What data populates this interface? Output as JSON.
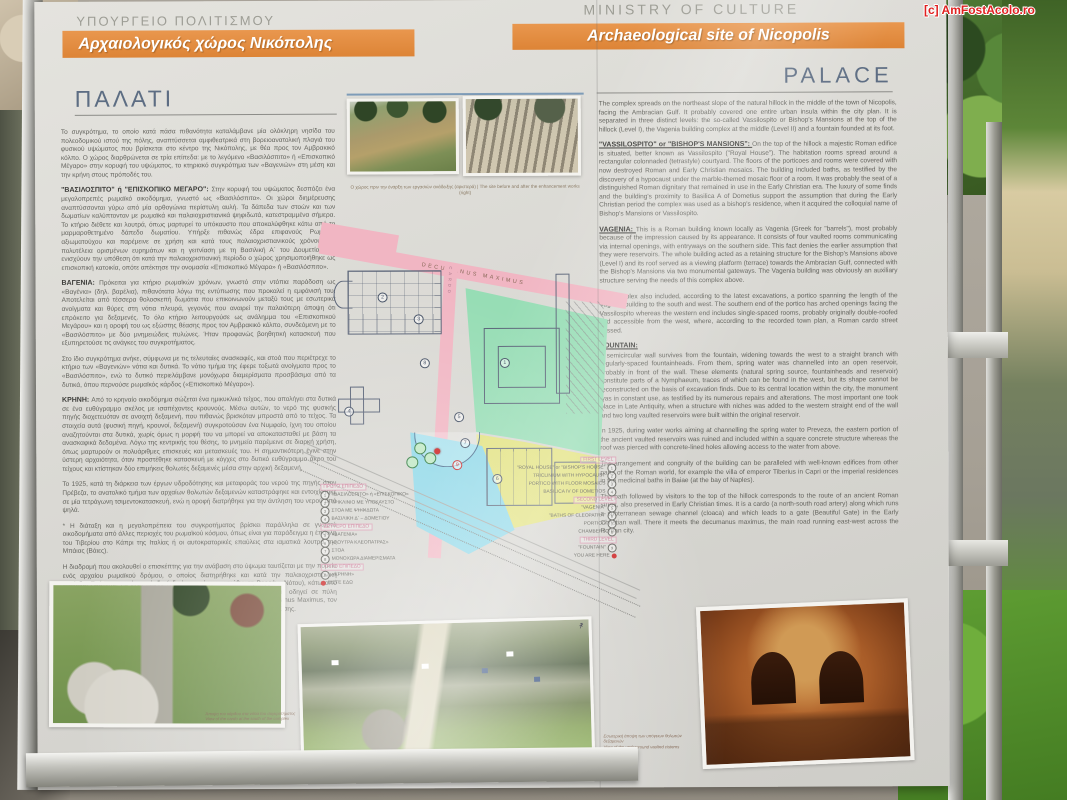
{
  "watermark": "[c] AmFostAcolo.ro",
  "header": {
    "gr": {
      "ministry": "ΥΠΟΥΡΓΕΙΟ ΠΟΛΙΤΙΣΜΟΥ",
      "banner": "Αρχαιολογικός χώρος Νικόπολης",
      "title": "ΠΑΛΑΤΙ"
    },
    "en": {
      "ministry": "MINISTRY OF CULTURE",
      "banner": "Archaeological site of Nicopolis",
      "title": "PALACE"
    }
  },
  "colors": {
    "banner_orange": "#e08a3c",
    "title_blue": "#5d6d83",
    "map_green": "#97ddb5",
    "map_yellow": "#e2e27e",
    "map_cyan": "#8fd8e8",
    "map_pink": "#f1b6c3",
    "marker_red": "#cc2020"
  },
  "left": {
    "sections": [
      {
        "head": "",
        "text": "Το συγκρότημα, το οποίο κατά πάσα πιθανότητα καταλάμβανε μία ολόκληρη νησίδα του πολεοδομικού ιστού της πόλης, αναπτύσσεται αμφιθεατρικά στη βορειοανατολική πλαγιά του φυσικού υψώματος που βρίσκεται στο κέντρο της Νικόπολης, με θέα προς τον Αμβρακικό κόλπο. Ο χώρος διαρθρώνεται σε τρία επίπεδα: με το λεγόμενο «Βασιλόσπιτο» ή «Επισκοπικό Μέγαρο» στην κορυφή του υψώματος, το κτηριακό συγκρότημα των «Βαγενιών» στη μέση και την κρήνη στους πρόποδές του."
      },
      {
        "head": "\"ΒΑΣΙΛΟΣΠΙΤΟ\" ή \"ΕΠΙΣΚΟΠΙΚΟ ΜΕΓΑΡΟ\": ",
        "text": "Στην κορυφή του υψώματος δεσπόζει ένα μεγαλοπρεπές ρωμαϊκό οικοδόμημα, γνωστό ως «Βασιλόσπιτο». Οι χώροι διημέρευσης αναπτύσσονται γύρω από μία ορθογώνια περίστυλη αυλή. Τα δάπεδα των στοών και των δωματίων καλύπτονταν με ρωμαϊκά και παλαιοχριστιανικά ψηφιδωτά, κατεστραμμένα σήμερα. Το κτήριο διέθετε και λουτρά, όπως μαρτυρεί το υπόκαυστο που αποκαλύφθηκε κάτω από το μαρμαροθετημένο δάπεδο δωματίου. Υπήρξε πιθανώς έδρα επιφανούς Ρωμαίου αξιωματούχου και παρέμεινε σε χρήση και κατά τους παλαιοχριστιανικούς χρόνους. Η πολυτέλεια ορισμένων ευρημάτων και η γειτνίαση με τη Βασιλική Α΄ του Δουμετίου (Σ) ενισχύουν την υπόθεση ότι κατά την παλαιοχριστιανική περίοδο ο χώρος χρησιμοποιήθηκε ως επισκοπική κατοικία, οπότε απέκτησε την ονομασία «Επισκοπικό Μέγαρο» ή «Βασιλόσπιτο»."
      },
      {
        "head": "ΒΑΓΕΝΙΑ: ",
        "text": "Πρόκειται για κτήριο ρωμαϊκών χρόνων, γνωστό στην ντόπια παράδοση ως «Βαγένια» (δηλ. βαρέλια), πιθανότατα λόγω της εντύπωσης που προκαλεί η εμφάνισή του. Αποτελείται από τέσσερα θολοσκεπή δωμάτια που επικοινωνούν μεταξύ τους με εσωτερικά ανοίγματα και θύρες στη νότια πλευρά, γεγονός που αναιρεί την παλαιότερη άποψη ότι επρόκειτο για δεξαμενές. Το όλο κτήριο λειτουργούσε ως ανάλημμα του «Επισκοπικού Μεγάρου» και η οροφή του ως εξώστης θέασης προς τον Αμβρακικό κόλπο, συνδεόμενη με το «Βασιλόσπιτο» με δύο μνημειώδεις πυλώνες. Ήταν προφανώς βοηθητική κατασκευή που εξυπηρετούσε τις ανάγκες του συγκροτήματος."
      },
      {
        "head": "",
        "text": "Στο ίδιο συγκρότημα ανήκε, σύμφωνα με τις τελευταίες ανασκαφές, και στοά που περιέτρεχε το κτήριο των «Βαγενιών» νότια και δυτικά. Το νότιο τμήμα της έφερε τοξωτά ανοίγματα προς το «Βασιλόσπιτο», ενώ το δυτικό περιελάμβανε μονόχωρα διαμερίσματα προσβάσιμα από τα δυτικά, όπου περνούσε ρωμαϊκός κάρδος («Επισκοπικό Μέγαρο»)."
      },
      {
        "head": "ΚΡΗΝΗ: ",
        "text": "Από το κρηναίο οικοδόμημα σώζεται ένα ημικυκλικό τείχος, που απολήγει στα δυτικά σε ένα ευθύγραμμο σκέλος με ισαπέχοντες κρουνούς. Μέσω αυτών, το νερό της φυσικής πηγής διοχετευόταν σε ανοιχτή δεξαμενή, που πιθανώς βρισκόταν μπροστά από το τείχος. Τα στοιχεία αυτά (φυσική πηγή, κρουνοί, δεξαμενή) συγκροτούσαν ένα Νυμφαίο, ίχνη του οποίου αναζητούνται στα δυτικά, χωρίς όμως η μορφή του να μπορεί να αποκατασταθεί με βάση τα ανασκαφικά δεδομένα. Λόγω της κεντρικής του θέσης, το μνημείο παρέμεινε σε διαρκή χρήση, όπως μαρτυρούν οι πολυάριθμες επισκευές και μετασκευές του. Η σημαντικότερη έγινε στην ύστερη αρχαιότητα, όταν προστέθηκε κατασκευή με κόγχες στο δυτικό ευθύγραμμο άκρο του τείχους και κτίστηκαν δύο επιμήκεις θολωτές δεξαμενές μέσα στην αρχική δεξαμενή."
      },
      {
        "head": "",
        "text": "Το 1925, κατά τη διάρκεια των έργων υδροδότησης και μεταφοράς του νερού της πηγής στην Πρέβεζα, το ανατολικό τμήμα των αρχαίων θολωτών δεξαμενών καταστράφηκε και εντοιχίστηκε σε μία τετράγωνη τσιμεντοκατασκευή, ενώ η οροφή διατρήθηκε για την άντληση του νερού από ψηλά."
      },
      {
        "head": "",
        "text": "* Η διάταξη και η μεγαλοπρέπεια του συγκροτήματος βρίσκει παράλληλα σε γνωστά οικοδομήματα από άλλες περιοχές του ρωμαϊκού κόσμου, όπως είναι για παράδειγμα η έπαυλη του Τιβερίου στο Κάπρι της Ιταλίας ή οι αυτοκρατορικές επαύλεις στα ιαματικά λουτρά της Μπάιας (Βάιες)."
      },
      {
        "head": "",
        "text": "Η διαδρομή που ακολουθεί ο επισκέπτης για την ανάβαση στο ύψωμα ταυτίζεται με την πορεία ενός αρχαίου ρωμαϊκού δρόμου, ο οποίος διατηρήθηκε και κατά την παλαιοχριστιανική περίοδο. Πρόκειται για έναν κάρδο (οδική αρτηρία με κατεύθυνση Βορρά – Νότου), κάτω από τον οποίο τρέχει υπόγειος αποχετευτικός αγωγός (cloaca), και ο οποίος οδηγεί σε πύλη («Ωραία Πύλη») του παλαιοχριστιανικού τείχους. Εκεί συναντά τον Decumanus Maximus, τον κεντρικό δρόμο που διέσχιζε τη ρωμαϊκή πόλη με κατεύθυνση Ανατολής – Δύσης."
      }
    ]
  },
  "right": {
    "sections": [
      {
        "head": "",
        "text": "The complex spreads on the northeast slope of the natural hillock in the middle of the town of Nicopolis, facing the Ambracian Gulf. It probably covered one entire urban insula within the city plan. It is separated in three distinct levels: the so-called Vassilospito or Bishop's Mansions at the top of the hillock (Level I), the Vagenia building complex at the middle (Level II) and a fountain founded at its foot."
      },
      {
        "head": "\"VASSILOSPITO\" or \"BISHOP'S MANSIONS\": ",
        "text": "On the top of the hillock a majestic Roman edifice is situated, better known as Vassilospito (\"Royal House\"). The habitation rooms spread around a rectangular colonnaded (tetrastyle) courtyard. The floors of the porticoes and rooms were covered with now destroyed Roman and Early Christian mosaics. The building included baths, as testified by the discovery of a hypocaust under the marble-themed mosaic floor of a room. It was probably the seat of a distinguished Roman dignitary that remained in use in the Early Christian era. The luxury of some finds and the building's proximity to Basilica A of Dometius support the assumption that during the Early Christian period the complex was used as a bishop's residence, when it acquired the colloquial name of Bishop's Mansions or Vassilospito."
      },
      {
        "head": "VAGENIA: ",
        "text": "This is a Roman building known locally as Vagenia (Greek for \"barrels\"), most probably because of the impression caused by its appearance. It consists of four vaulted rooms communicating via internal openings, with entryways on the southern side. This fact denies the earlier assumption that they were reservoirs. The whole building acted as a retaining structure for the Bishop's Mansions above (Level I) and its roof served as a viewing platform (terrace) towards the Ambracian Gulf, connected with the Bishop's Mansions via two monumental gateways. The Vagenia building was obviously an auxiliary structure serving the needs of this complex above."
      },
      {
        "head": "",
        "text": "The complex also included, according to the latest excavations, a portico spanning the length of the Vagenia building to the south and west. The southern end of the portico has arched openings facing the Vassilospito whereas the western end includes single-spaced rooms, probably originally double-roofed and accessible from the west, where, according to the recorded town plan, a Roman cardo street passed."
      },
      {
        "head": "FOUNTAIN: ",
        "text": "A semicircular wall survives from the fountain, widening towards the west to a straight branch with regularly-spaced fountainheads. From them, spring water was channelled into an open reservoir, probably in front of the wall. These elements (natural spring source, fountainheads and reservoir) constitute parts of a Nymphaeum, traces of which can be found in the west, but its shape cannot be reconstructed on the basis of excavation finds. Due to its central location within the city, the monument was in constant use, as testified by its numerous repairs and alterations. The most important one took place in Late Antiquity, when a structure with niches was added to the western straight end of the wall and two long vaulted reservoirs were built within the original reservoir."
      },
      {
        "head": "",
        "text": "In 1925, during water works aiming at channelling the spring water to Preveza, the eastern portion of the ancient vaulted reservoirs was ruined and included within a square concrete structure whereas the roof was pierced with concrete-lined holes allowing access to the water from above."
      },
      {
        "head": "",
        "text": "The arrangement and congruity of the building can be paralleled with well-known edifices from other parts of the Roman world, for example the villa of emperor Tiberius in Capri or the imperial residences in the medicinal baths in Baiae (at the bay of Naples)."
      },
      {
        "head": "",
        "text": "The path followed by visitors to the top of the hillock corresponds to the route of an ancient Roman street, also preserved in Early Christian times. It is a cardo (a north-south road artery) along which runs a subterranean sewage channel (cloaca) and which leads to a gate (Beautiful Gate) in the Early Christian wall. There it meets the decumanus maximus, the main road running east-west across the Roman city."
      }
    ]
  },
  "map": {
    "decumanus_label": "DECUMANUS MAXIMUS",
    "cardo_label": "CARDO",
    "markers": [
      "1",
      "2",
      "3",
      "4",
      "5",
      "6",
      "7",
      "8",
      "9"
    ],
    "legend_gr": {
      "rows": [
        {
          "n": "",
          "label": "ΠΡΩΤΟ ΕΠΙΠΕΔΟ"
        },
        {
          "n": "1",
          "label": "«ΒΑΣΙΛΟΣΠΙΤΟ» ή «ΕΠΙΣΚΟΠΙΚΟ»"
        },
        {
          "n": "2",
          "label": "ΤΡΙΚΛΙΝΙΟ ΜΕ ΥΠΟΚΑΥΣΤΟ"
        },
        {
          "n": "3",
          "label": "ΣΤΟΑ ΜΕ ΨΗΦΙΔΩΤΑ"
        },
        {
          "n": "4",
          "label": "ΒΑΣΙΛΙΚΗ Δ΄ – ΔΟΜΕΤΙΟΥ"
        },
        {
          "n": "",
          "label": "ΔΕΥΤΕΡΟ ΕΠΙΠΕΔΟ"
        },
        {
          "n": "5",
          "label": "«ΒΑΓΕΝΙΑ»"
        },
        {
          "n": "6",
          "label": "«ΛΟΥΤΡΑ ΚΛΕΟΠΑΤΡΑΣ»"
        },
        {
          "n": "7",
          "label": "ΣΤΟΑ"
        },
        {
          "n": "8",
          "label": "ΜΟΝΟΧΩΡΑ ΔΙΑΜΕΡΙΣΜΑΤΑ"
        },
        {
          "n": "",
          "label": "ΤΡΙΤΟ ΕΠΙΠΕΔΟ"
        },
        {
          "n": "9",
          "label": "«ΚΡΗΝΗ»"
        },
        {
          "n": "dot",
          "label": "ΕΙΣΤΕ ΕΔΩ"
        }
      ]
    },
    "legend_en": {
      "rows": [
        {
          "n": "",
          "label": "FIRST LEVEL"
        },
        {
          "n": "1",
          "label": "\"ROYAL HOUSE\" or \"BISHOP'S HOUSE\""
        },
        {
          "n": "2",
          "label": "TRICLINIUM WITH HYPOCAUST"
        },
        {
          "n": "3",
          "label": "PORTICO WITH FLOOR MOSAICS"
        },
        {
          "n": "4",
          "label": "BASILICA IV OF DOMETIOS"
        },
        {
          "n": "",
          "label": "SECOND LEVEL"
        },
        {
          "n": "5",
          "label": "\"VAGENIA\""
        },
        {
          "n": "6",
          "label": "\"BATHS OF CLEOPATRA\""
        },
        {
          "n": "7",
          "label": "PORTICO"
        },
        {
          "n": "8",
          "label": "CHAMBERS"
        },
        {
          "n": "",
          "label": "THIRD LEVEL"
        },
        {
          "n": "9",
          "label": "\"FOUNTAIN\""
        },
        {
          "n": "dot",
          "label": "YOU ARE HERE"
        }
      ]
    }
  },
  "photos": {
    "top_caption": "Ο χώρος πριν την έναρξη των εργασιών ανάδειξης (αριστερά)  |  The site before and after the enhancement works (right)",
    "aerial_gr": "Άποψη του κάρδου στα νότια του συγκροτήματος",
    "aerial_en": "View of the cardo at the south of the complex",
    "cistern_gr": "Εσωτερική άποψη των υπόγειων θολωτών δεξαμενών",
    "cistern_en": "View of the underground vaulted cisterns"
  }
}
